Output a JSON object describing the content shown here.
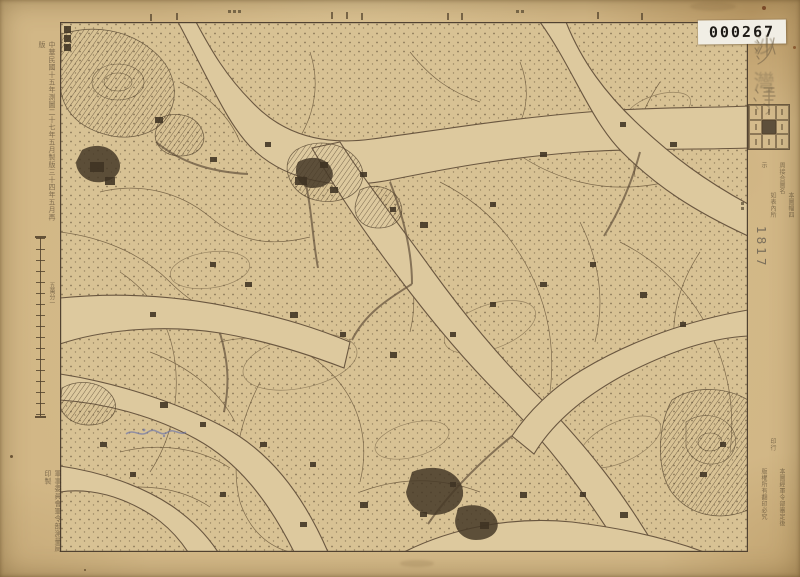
{
  "stamp": {
    "number": "000267"
  },
  "sheet": {
    "title": "沙灣",
    "handwritten_number": "1817"
  },
  "imprints": {
    "left_top": "中華民國十五年測圖二十七年五月製版三十四年五月再版",
    "left_bottom": "軍事委員會軍令部測量局印製",
    "scale_label": "五萬分一",
    "index_note_col1": "本圖幅四周接合圖名",
    "index_note_col2": "如表內所示",
    "right_bottom_col1": "本圖經軍令部審定後印行",
    "right_bottom_col2": "版權所有翻印必究"
  },
  "colors": {
    "paper": "#d2b786",
    "map_paper": "#d8c294",
    "ink": "#5a4833",
    "stamp_bg": "#f1eee5",
    "stamp_text": "#1d1a16",
    "pencil": "#6c6353",
    "blue_pencil": "#5866ae"
  }
}
